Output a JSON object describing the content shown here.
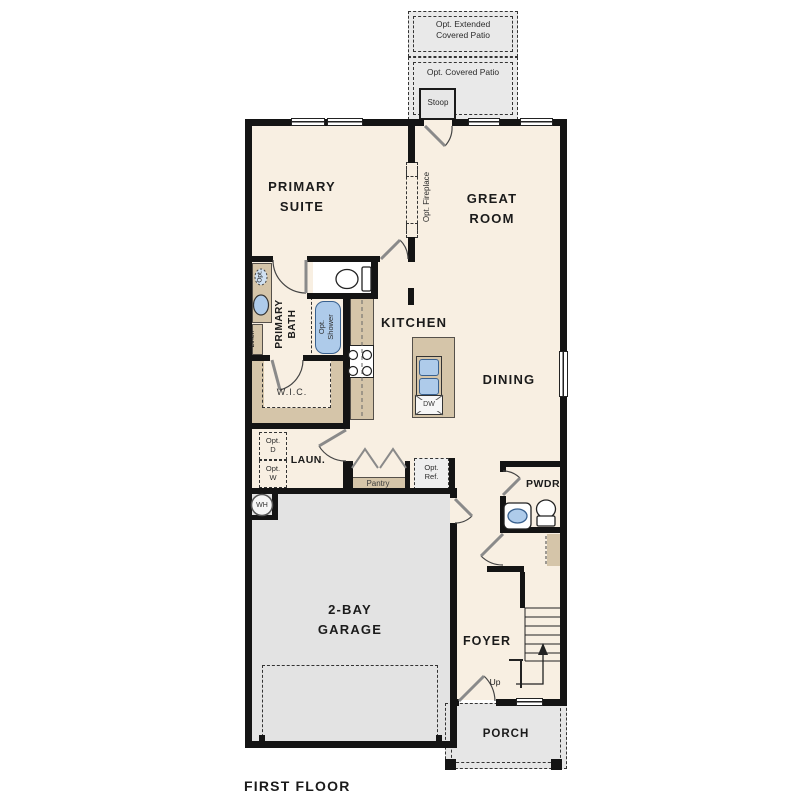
{
  "plan_title": "FIRST FLOOR",
  "rooms": {
    "primary_suite": "PRIMARY\nSUITE",
    "great_room": "GREAT\nROOM",
    "primary_bath": "PRIMARY\nBATH",
    "wic": "W.I.C.",
    "kitchen": "KITCHEN",
    "dining": "DINING",
    "laundry": "LAUN.",
    "powder": "PWDR",
    "garage": "2-BAY\nGARAGE",
    "foyer": "FOYER",
    "porch": "PORCH",
    "stoop": "Stoop"
  },
  "options": {
    "extended_patio": "Opt. Extended\nCovered Patio",
    "covered_patio": "Opt. Covered Patio",
    "fireplace": "Opt. Fireplace",
    "shower": "Opt.\nShower",
    "dryer": "Opt.\nD",
    "washer": "Opt.\nW",
    "refrigerator": "Opt.\nRef.",
    "second_sink": "Opt."
  },
  "fixtures": {
    "dishwasher": "DW",
    "water_heater": "WH",
    "pantry": "Pantry",
    "linen": "Linen",
    "stairs_up": "Up"
  },
  "colors": {
    "wall": "#141414",
    "floor": "#f8efe2",
    "garage_floor": "#e3e3e3",
    "patio_fill": "#e9e9e9",
    "porch_fill": "#e6e6e6",
    "cabinet_tan": "#d5c5a9",
    "fixture_blue": "#aecbea",
    "door_gray": "#8a8a8a"
  }
}
